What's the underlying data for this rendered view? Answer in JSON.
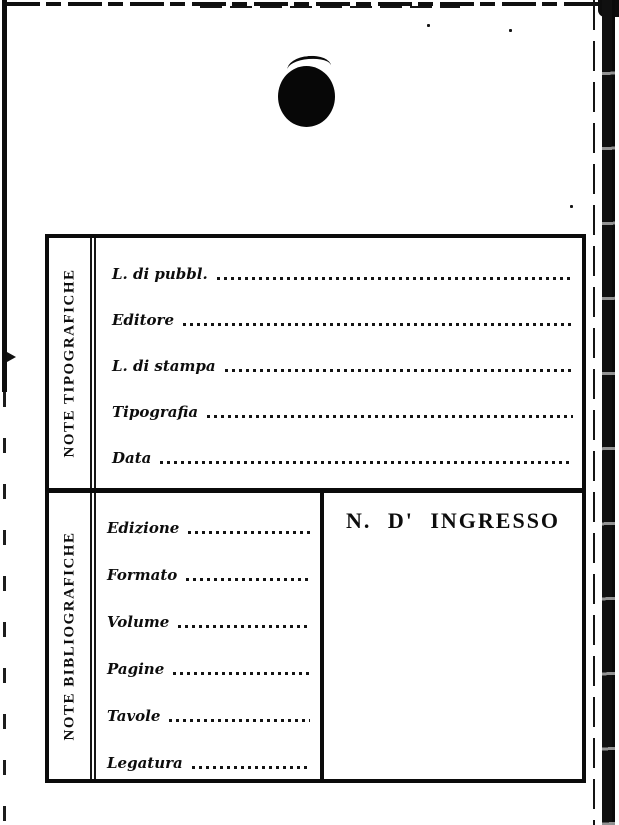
{
  "colors": {
    "paper": "#ffffff",
    "ink": "#0d0d0d"
  },
  "card": {
    "sections": [
      {
        "side_label": "NOTE TIPOGRAFICHE",
        "fields": [
          {
            "label": "L. di pubbl.",
            "value": ""
          },
          {
            "label": "Editore",
            "value": ""
          },
          {
            "label": "L. di stampa",
            "value": ""
          },
          {
            "label": "Tipografia",
            "value": ""
          },
          {
            "label": "Data",
            "value": ""
          }
        ]
      },
      {
        "side_label": "NOTE BIBLIOGRAFICHE",
        "fields": [
          {
            "label": "Edizione",
            "value": ""
          },
          {
            "label": "Formato",
            "value": ""
          },
          {
            "label": "Volume",
            "value": ""
          },
          {
            "label": "Pagine",
            "value": ""
          },
          {
            "label": "Tavole",
            "value": ""
          },
          {
            "label": "Legatura",
            "value": ""
          }
        ],
        "ingresso_heading": "N. D' INGRESSO"
      }
    ]
  },
  "decorations": {
    "punch_hole": "punch-hole",
    "scan_artifacts": [
      "top-edge-line",
      "right-edge-band",
      "left-edge-line",
      "top-right-corner-blob"
    ]
  }
}
